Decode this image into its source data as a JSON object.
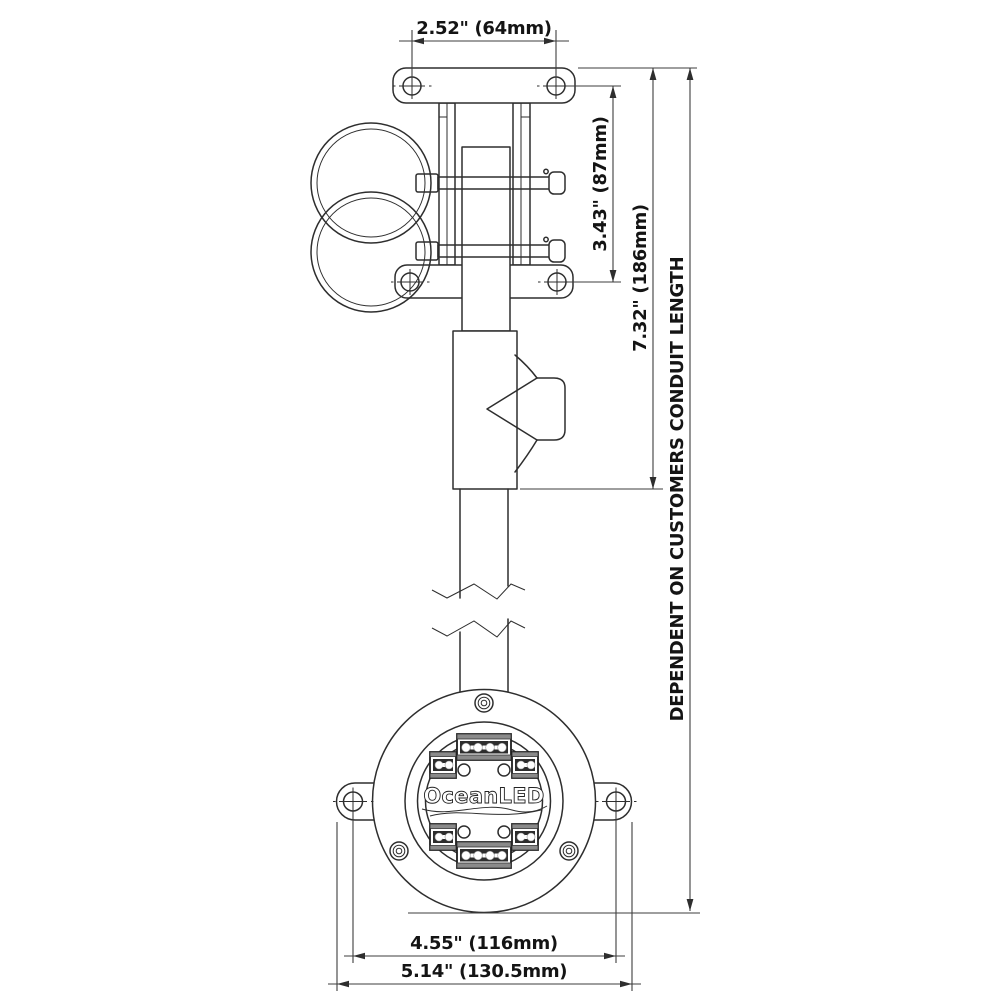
{
  "drawing": {
    "brand_logo": "OceanLED",
    "dimensions": {
      "top_hole_spacing": "2.52\" (64mm)",
      "clamp_hole_spacing": "3.43\" (87mm)",
      "bracket_total_height": "7.32\" (186mm)",
      "conduit_note": "DEPENDENT ON CUSTOMERS CONDUIT LENGTH",
      "fixture_hole_spacing": "4.55\" (116mm)",
      "fixture_overall_width": "5.14\" (130.5mm)"
    },
    "colors": {
      "line": "#2e2e2e",
      "dimension_line": "#3e3e3e",
      "text": "#141414",
      "background": "#ffffff"
    }
  }
}
